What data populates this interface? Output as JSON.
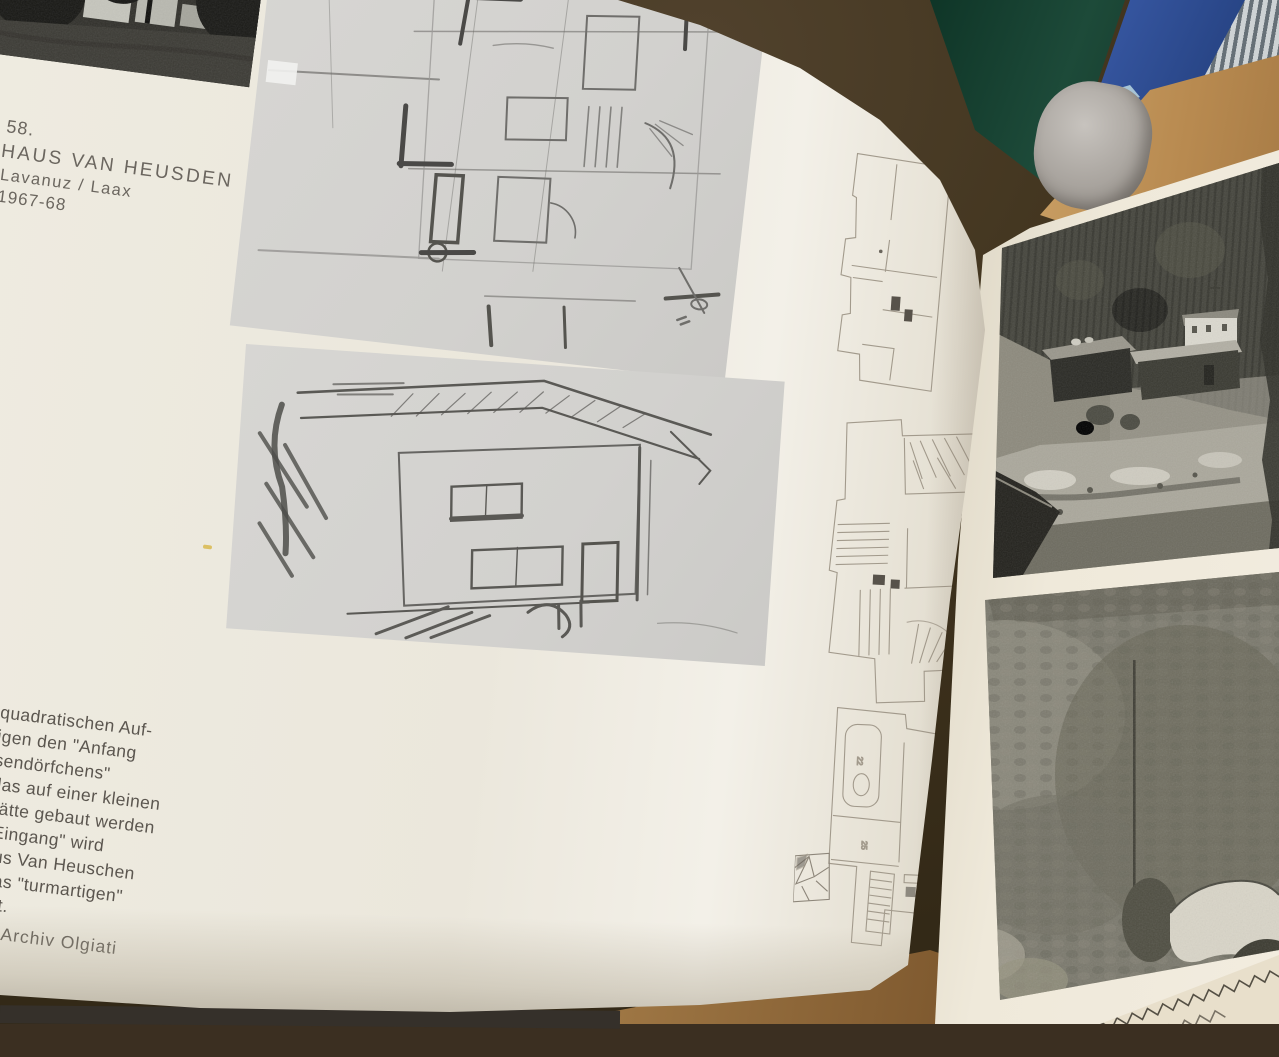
{
  "book": {
    "left_page": {
      "caption": {
        "figure_number": "58.",
        "title": "HAUS VAN HEUSDEN",
        "location": "Lavanuz / Laax",
        "years": "1967-68"
      },
      "paragraph_lines": [
        "quadratischen Auf-",
        "igen den \"Anfang",
        "sendörfchens\"",
        "das auf einer kleinen",
        "hätte gebaut werden",
        "\"Eingang\" wird",
        "aus Van Heuschen",
        "was \"turmartigen\"",
        "iert."
      ],
      "credit": "Archiv Olgiati",
      "plan_labels": {
        "tub_room": "22",
        "mid_room": "25"
      }
    },
    "palette": {
      "page_cream": "#ece8dc",
      "sketch_paper": "#d5d4d1",
      "pencil_gray": "#5a5956",
      "plan_line": "#a39c90",
      "background_brown": "#3b2f21",
      "green_binder": "#1d4a39",
      "blue_binder": "#3a5ba8",
      "cardboard": "#b88a50",
      "wood": "#9b7340",
      "fabric": "#e8dfcb",
      "photo_dark": "#3c3b35",
      "photo_light": "#cfccc2"
    }
  }
}
